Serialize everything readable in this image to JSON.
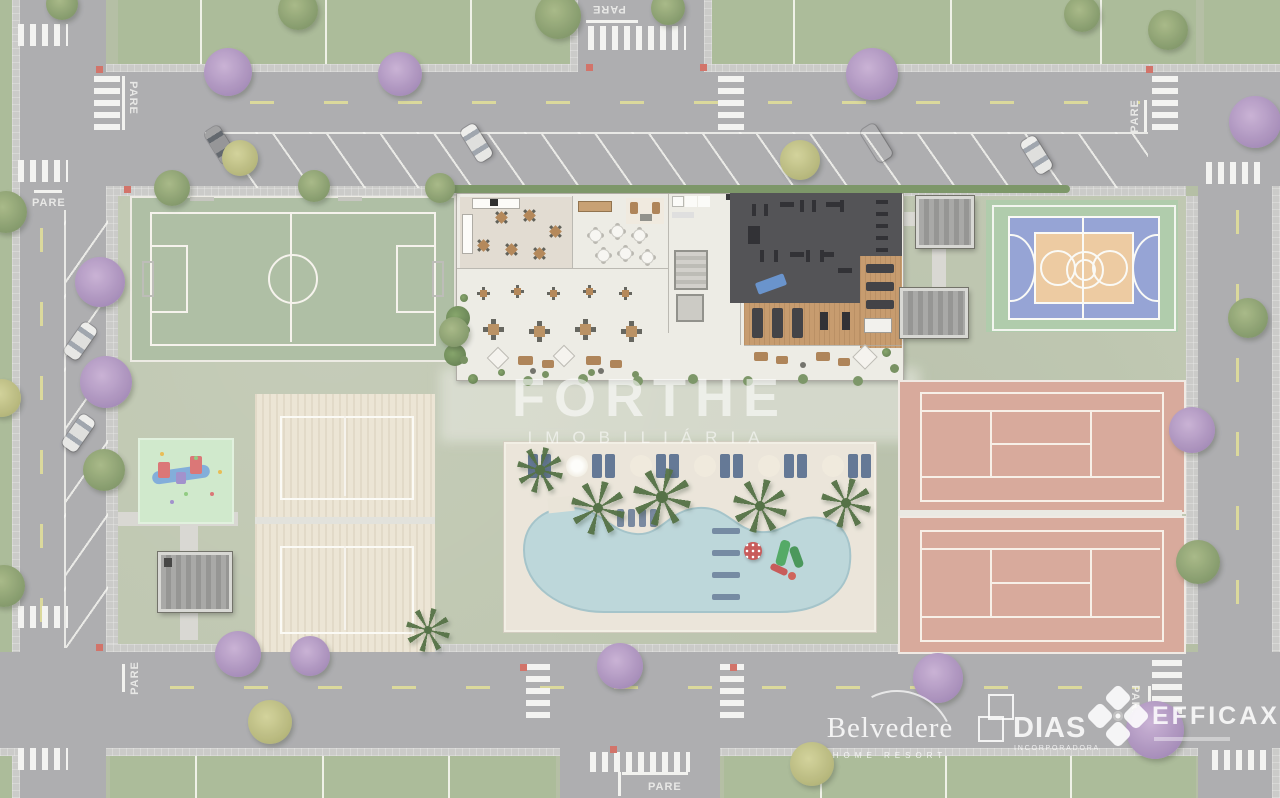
{
  "watermark": {
    "title": "FORTHE",
    "subtitle": "IMOBILIÁRIA"
  },
  "road_markings": {
    "stop_label": "PARE"
  },
  "branding": {
    "partners": [
      {
        "name": "Belvedere",
        "tagline": "HOME RESORT"
      },
      {
        "name": "DIAS",
        "tagline": "INCORPORADORA"
      },
      {
        "name": "EFFICAX",
        "tagline": ""
      }
    ]
  },
  "palette": {
    "road": "#a8a8ab",
    "lot_grass": "#a6b793",
    "block_grass": "#bcc4ad",
    "sidewalk": "#c8c8c5",
    "marking_white": "#f3f3f0",
    "lane_dash_yellow": "#d9d795",
    "soccer_green": "#a9bb9f",
    "basketball_blue": "#8e9ed2",
    "basketball_key_orange": "#ecc79b",
    "court_surround_green": "#abc9a6",
    "tennis_clay": "#d5a495",
    "sand": "#ebe4d2",
    "pool_deck": "#eae4d8",
    "pool_water": "#b9d4d8",
    "gym_floor": "#47474b",
    "wood_deck": "#c39565",
    "playground_mint": "#cde8c9",
    "lounger_blue": "#5a6f8f",
    "tree_green": "#7c9362",
    "tree_purple": "#a186b5",
    "tree_yellow": "#b0b172",
    "tactile_red": "#cf6a5f"
  }
}
